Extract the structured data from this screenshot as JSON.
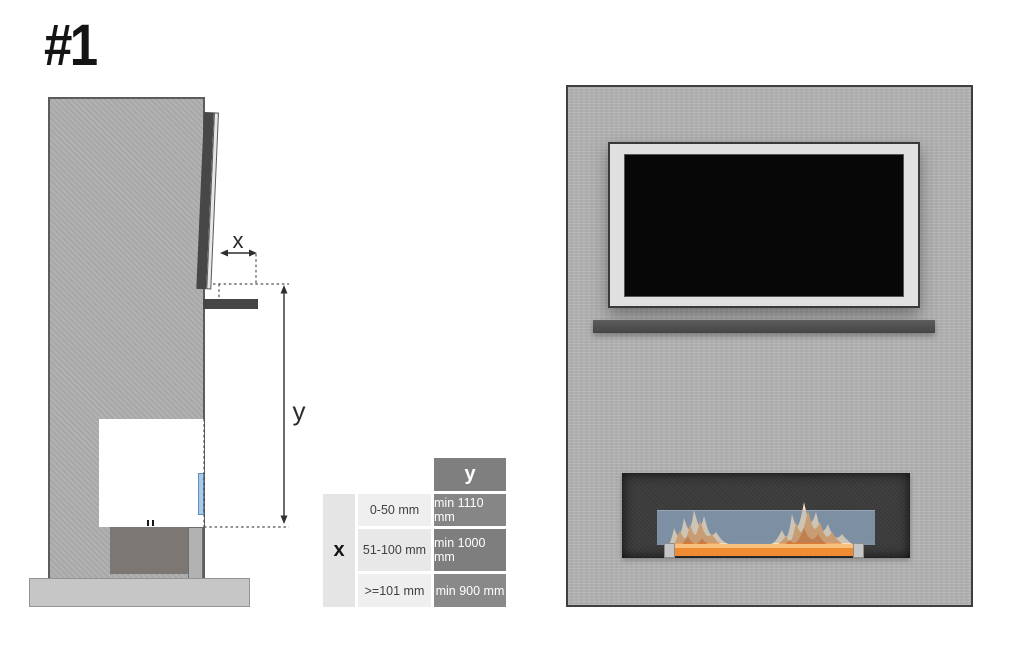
{
  "figure": {
    "number": "#1"
  },
  "side_view": {
    "x_label": "x",
    "y_label": "y"
  },
  "table": {
    "col_header": "y",
    "row_header": "x",
    "rows": [
      {
        "range": "0-50 mm",
        "min_y": "min 1110 mm"
      },
      {
        "range": "51-100 mm",
        "min_y": "min 1000 mm"
      },
      {
        "range": ">=101 mm",
        "min_y": "min 900 mm"
      }
    ]
  },
  "colors": {
    "wall_gray": "#b4b4b4",
    "shelf_dark": "#4a4a4a",
    "recess_dark": "#3d3d3d",
    "glass_blue": "#8093a6",
    "side_glass_blue": "#a9cbe9",
    "flame_orange": "#e2792c",
    "flame_cream": "#f7dfc0",
    "table_header_gray": "#7f7f7f"
  }
}
